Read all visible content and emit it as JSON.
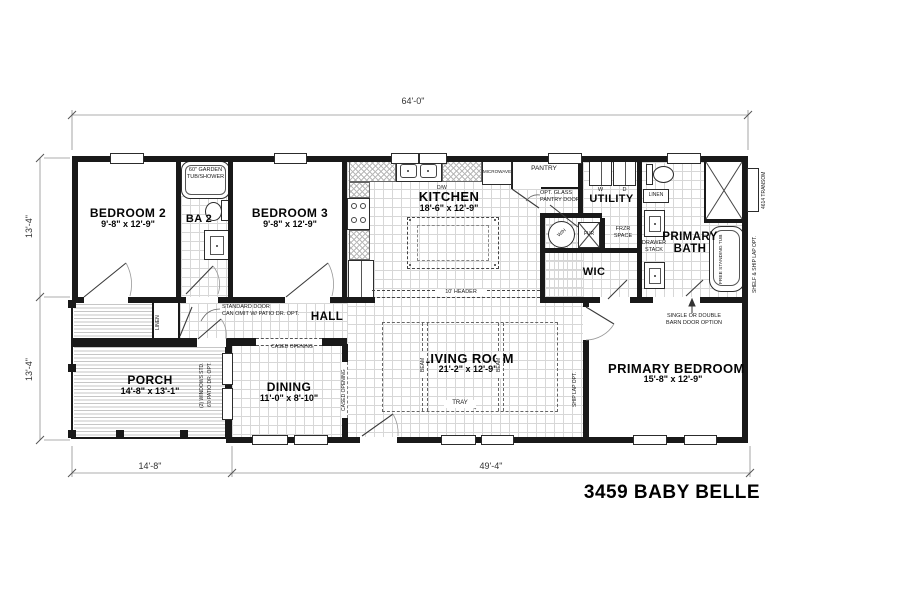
{
  "title": "3459 BABY BELLE",
  "dimensions": {
    "overall_width": "64'-0\"",
    "left_upper": "13'-4\"",
    "left_lower": "13'-4\"",
    "porch_width": "14'-8\"",
    "main_width": "49'-4\""
  },
  "rooms": {
    "bedroom2": {
      "name": "BEDROOM 2",
      "size": "9'-8\" x 12'-9\""
    },
    "bath2": {
      "name": "BA 2"
    },
    "bedroom3": {
      "name": "BEDROOM 3",
      "size": "9'-8\" x 12'-9\""
    },
    "kitchen": {
      "name": "KITCHEN",
      "size": "18'-6\" x 12'-9\""
    },
    "utility": {
      "name": "UTILITY"
    },
    "primary_bath": {
      "name": "PRIMARY BATH"
    },
    "wic": {
      "name": "WIC"
    },
    "hall": {
      "name": "HALL"
    },
    "porch": {
      "name": "PORCH",
      "size": "14'-8\" x 13'-1\""
    },
    "dining": {
      "name": "DINING",
      "size": "11'-0\" x 8'-10\""
    },
    "living_room": {
      "name": "LIVING ROOM",
      "size": "21'-2\" x 12'-9\""
    },
    "primary_bedroom": {
      "name": "PRIMARY BEDROOM",
      "size": "15'-8\" x 12'-9\""
    }
  },
  "fixtures": {
    "garden_tub_line1": "60\" GARDEN",
    "garden_tub_line2": "TUB/SHOWER",
    "dishwasher": "D/W",
    "microwave": "MICROWAVE",
    "pantry": "PANTRY",
    "washer": "W",
    "dryer": "D",
    "water_heater": "W/H",
    "furnace": "FUR",
    "freezer_line1": "FRZR",
    "freezer_line2": "SPACE",
    "linen_bath": "LINEN",
    "linen_hall": "LINEN",
    "drawer_stack_line1": "DRAWER",
    "drawer_stack_line2": "STACK",
    "free_standing_tub": "FREE STANDING TUB",
    "transom": "4614 TRANSOM"
  },
  "notes": {
    "opt_glass_line1": "OPT. GLASS",
    "opt_glass_line2": "PANTRY DOOR",
    "standard_door_line1": "STANDARD DOOR",
    "standard_door_line2": "CAN OMIT W/ PATIO DR. OPT.",
    "cased_opening_dining": "CASED OPENING",
    "cased_opening_living": "CASED OPENING",
    "header": "10' HEADER",
    "tray": "TRAY",
    "beam_left": "BEAM",
    "beam_right": "BEAM",
    "ship_lap": "SHIP LAP OPT.",
    "shelf_ship_lap": "SHELF & SHIP LAP OPT.",
    "barn_door_line1": "SINGLE OR DOUBLE",
    "barn_door_line2": "BARN DOOR OPTION",
    "windows_std": "(2) WINDOWS STD.",
    "patio_door": "6'0 PATIO DR. OPT."
  }
}
